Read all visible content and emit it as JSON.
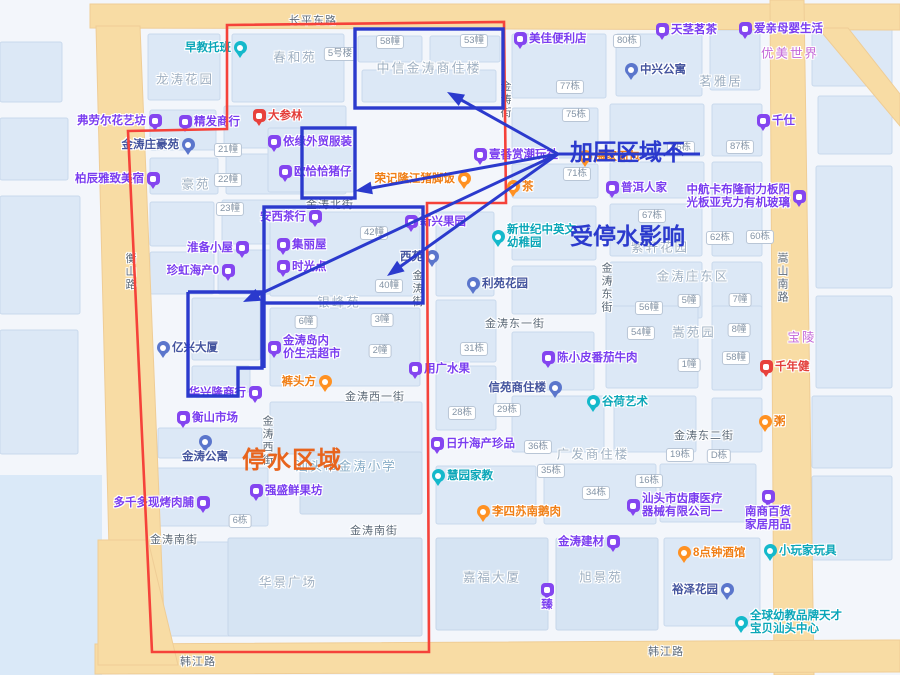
{
  "annotations": {
    "pressure": {
      "line1": "加压区域不",
      "line2": "受停水影响",
      "color": "#2b3acd",
      "x": 570,
      "y": 82
    },
    "outage": {
      "label": "停水区域",
      "color": "#e8641d",
      "x": 242,
      "y": 440
    }
  },
  "roads": {
    "labels": [
      {
        "t": "长平东路",
        "x": 313,
        "y": 20
      },
      {
        "t": "韩江路",
        "x": 198,
        "y": 661
      },
      {
        "t": "韩江路",
        "x": 666,
        "y": 651
      },
      {
        "t": "衡山路",
        "x": 130,
        "y": 272,
        "v": true
      },
      {
        "t": "金涛北街",
        "x": 330,
        "y": 204
      },
      {
        "t": "金涛街",
        "x": 417,
        "y": 289,
        "v": true
      },
      {
        "t": "金涛街",
        "x": 505,
        "y": 100,
        "v": true
      },
      {
        "t": "金涛东街",
        "x": 606,
        "y": 288,
        "v": true
      },
      {
        "t": "嵩山南路",
        "x": 782,
        "y": 278,
        "v": true
      },
      {
        "t": "金涛东一街",
        "x": 515,
        "y": 323
      },
      {
        "t": "金涛西一街",
        "x": 375,
        "y": 396
      },
      {
        "t": "金涛东二街",
        "x": 704,
        "y": 435
      },
      {
        "t": "金涛南街",
        "x": 174,
        "y": 539
      },
      {
        "t": "金涛南街",
        "x": 374,
        "y": 530
      },
      {
        "t": "金涛西街",
        "x": 267,
        "y": 441,
        "v": true
      }
    ]
  },
  "areas": {
    "labels": [
      {
        "t": "龙涛花园",
        "x": 185,
        "y": 78
      },
      {
        "t": "春和苑",
        "x": 295,
        "y": 56
      },
      {
        "t": "中信金涛商住楼",
        "x": 429,
        "y": 67,
        "fs": 13
      },
      {
        "t": "豪苑",
        "x": 196,
        "y": 183
      },
      {
        "t": "茗雅居",
        "x": 721,
        "y": 80
      },
      {
        "t": "优美世界",
        "x": 790,
        "y": 52,
        "c": "#c468d8"
      },
      {
        "t": "紫轩花园",
        "x": 660,
        "y": 246
      },
      {
        "t": "金涛庄东区",
        "x": 693,
        "y": 275
      },
      {
        "t": "嵩苑园",
        "x": 694,
        "y": 331
      },
      {
        "t": "银峰苑",
        "x": 339,
        "y": 301
      },
      {
        "t": "华景广场",
        "x": 288,
        "y": 581
      },
      {
        "t": "嘉福大厦",
        "x": 492,
        "y": 576
      },
      {
        "t": "旭景苑",
        "x": 601,
        "y": 576
      },
      {
        "t": "汕头市金涛小学",
        "x": 346,
        "y": 465,
        "c": "#85abc6"
      },
      {
        "t": "广发商住楼",
        "x": 593,
        "y": 453
      },
      {
        "t": "宝陵",
        "x": 802,
        "y": 336,
        "c": "#c468d8"
      }
    ]
  },
  "buildings": {
    "badges": [
      {
        "t": "21幢",
        "x": 228,
        "y": 150
      },
      {
        "t": "22幢",
        "x": 228,
        "y": 180
      },
      {
        "t": "23幢",
        "x": 230,
        "y": 209
      },
      {
        "t": "5号楼",
        "x": 340,
        "y": 54
      },
      {
        "t": "58幢",
        "x": 390,
        "y": 42
      },
      {
        "t": "53幢",
        "x": 474,
        "y": 41
      },
      {
        "t": "80栋",
        "x": 627,
        "y": 41
      },
      {
        "t": "77栋",
        "x": 570,
        "y": 87
      },
      {
        "t": "75栋",
        "x": 576,
        "y": 115
      },
      {
        "t": "86栋",
        "x": 681,
        "y": 148
      },
      {
        "t": "87栋",
        "x": 740,
        "y": 147
      },
      {
        "t": "71栋",
        "x": 577,
        "y": 174
      },
      {
        "t": "67栋",
        "x": 652,
        "y": 216
      },
      {
        "t": "62栋",
        "x": 720,
        "y": 238
      },
      {
        "t": "60栋",
        "x": 760,
        "y": 237
      },
      {
        "t": "42幢",
        "x": 374,
        "y": 233
      },
      {
        "t": "40幢",
        "x": 389,
        "y": 286
      },
      {
        "t": "6幢",
        "x": 306,
        "y": 322
      },
      {
        "t": "3幢",
        "x": 382,
        "y": 320
      },
      {
        "t": "2幢",
        "x": 380,
        "y": 351
      },
      {
        "t": "31栋",
        "x": 474,
        "y": 349
      },
      {
        "t": "28栋",
        "x": 462,
        "y": 413
      },
      {
        "t": "29栋",
        "x": 507,
        "y": 410
      },
      {
        "t": "36栋",
        "x": 538,
        "y": 447
      },
      {
        "t": "56幢",
        "x": 649,
        "y": 308
      },
      {
        "t": "54幢",
        "x": 641,
        "y": 333
      },
      {
        "t": "5幢",
        "x": 689,
        "y": 301
      },
      {
        "t": "7幢",
        "x": 740,
        "y": 300
      },
      {
        "t": "8幢",
        "x": 739,
        "y": 330
      },
      {
        "t": "58幢",
        "x": 736,
        "y": 358
      },
      {
        "t": "1幢",
        "x": 689,
        "y": 365
      },
      {
        "t": "35栋",
        "x": 551,
        "y": 471
      },
      {
        "t": "34栋",
        "x": 596,
        "y": 493
      },
      {
        "t": "16栋",
        "x": 649,
        "y": 481
      },
      {
        "t": "19栋",
        "x": 680,
        "y": 455
      },
      {
        "t": "D栋",
        "x": 719,
        "y": 456
      },
      {
        "t": "6栋",
        "x": 240,
        "y": 521
      }
    ]
  },
  "pois": {
    "markers": [
      {
        "t": "早教托班",
        "x": 240,
        "y": 48,
        "pin": "teal",
        "side": "left"
      },
      {
        "t": "弗劳尔花艺坊",
        "x": 155,
        "y": 121,
        "pin": "purple",
        "side": "left"
      },
      {
        "t": "精发商行",
        "x": 185,
        "y": 122,
        "pin": "purple",
        "side": "right"
      },
      {
        "t": "大参林",
        "x": 259,
        "y": 116,
        "pin": "red",
        "side": "right"
      },
      {
        "t": "金涛庄豪苑",
        "x": 188,
        "y": 145,
        "pin": "blue",
        "side": "left"
      },
      {
        "t": "柏辰雅致美宿",
        "x": 153,
        "y": 179,
        "pin": "purple",
        "side": "left"
      },
      {
        "t": "依缘外贸服装",
        "x": 274,
        "y": 142,
        "pin": "purple",
        "side": "right"
      },
      {
        "t": "欧恰恰猪仔",
        "x": 285,
        "y": 172,
        "pin": "purple",
        "side": "right"
      },
      {
        "t": "美佳便利店",
        "x": 520,
        "y": 39,
        "pin": "purple",
        "side": "right"
      },
      {
        "t": "天茎茗茶",
        "x": 662,
        "y": 30,
        "pin": "purple",
        "side": "right"
      },
      {
        "t": "爱亲母婴生活",
        "x": 745,
        "y": 29,
        "pin": "purple",
        "side": "right"
      },
      {
        "t": "中兴公寓",
        "x": 631,
        "y": 70,
        "pin": "blue",
        "side": "right"
      },
      {
        "t": "千仕",
        "x": 763,
        "y": 121,
        "pin": "purple",
        "side": "right"
      },
      {
        "t": "梅家面包",
        "x": 585,
        "y": 157,
        "pin": "orange",
        "side": "right"
      },
      {
        "t": "普洱人家",
        "x": 612,
        "y": 188,
        "pin": "purple",
        "side": "right"
      },
      {
        "t": "中航卡布隆耐力板阳\n光板亚克力有机玻璃",
        "x": 799,
        "y": 197,
        "pin": "purple",
        "side": "left"
      },
      {
        "t": "壹番赏潮玩社",
        "x": 480,
        "y": 155,
        "pin": "purple",
        "side": "right"
      },
      {
        "t": "荣记隆江猪脚饭",
        "x": 464,
        "y": 179,
        "pin": "orange",
        "side": "left"
      },
      {
        "t": "茶",
        "x": 513,
        "y": 187,
        "pin": "orange",
        "side": "right"
      },
      {
        "t": "安西茶行",
        "x": 315,
        "y": 217,
        "pin": "purple",
        "side": "left"
      },
      {
        "t": "新兴果园",
        "x": 411,
        "y": 222,
        "pin": "purple",
        "side": "right"
      },
      {
        "t": "集丽屋",
        "x": 283,
        "y": 245,
        "pin": "purple",
        "side": "right"
      },
      {
        "t": "时光点",
        "x": 283,
        "y": 267,
        "pin": "purple",
        "side": "right"
      },
      {
        "t": "西苑",
        "x": 432,
        "y": 257,
        "pin": "blue",
        "side": "left"
      },
      {
        "t": "新世纪中英文\n幼稚园",
        "x": 498,
        "y": 237,
        "pin": "teal",
        "side": "right"
      },
      {
        "t": "利苑花园",
        "x": 473,
        "y": 284,
        "pin": "blue",
        "side": "right"
      },
      {
        "t": "珍虹海产0",
        "x": 228,
        "y": 271,
        "pin": "purple",
        "side": "left"
      },
      {
        "t": "淮备小屋",
        "x": 242,
        "y": 248,
        "pin": "purple",
        "side": "left"
      },
      {
        "t": "亿兴大厦",
        "x": 163,
        "y": 348,
        "pin": "blue",
        "side": "right"
      },
      {
        "t": "金涛岛内\n价生活超市",
        "x": 274,
        "y": 348,
        "pin": "purple",
        "side": "right"
      },
      {
        "t": "华兴隆商行",
        "x": 255,
        "y": 393,
        "pin": "purple",
        "side": "left"
      },
      {
        "t": "衡山市场",
        "x": 183,
        "y": 418,
        "pin": "purple",
        "side": "right"
      },
      {
        "t": "金涛公寓",
        "x": 205,
        "y": 442,
        "pin": "blue",
        "side": "below"
      },
      {
        "t": "裤头方",
        "x": 325,
        "y": 382,
        "pin": "orange",
        "side": "left"
      },
      {
        "t": "用广水果",
        "x": 415,
        "y": 369,
        "pin": "purple",
        "side": "right"
      },
      {
        "t": "陈小皮番茄牛肉",
        "x": 548,
        "y": 358,
        "pin": "purple",
        "side": "right"
      },
      {
        "t": "信苑商住楼",
        "x": 555,
        "y": 388,
        "pin": "blue",
        "side": "left"
      },
      {
        "t": "日升海产珍品",
        "x": 437,
        "y": 444,
        "pin": "purple",
        "side": "right"
      },
      {
        "t": "谷荷艺术",
        "x": 593,
        "y": 402,
        "pin": "teal",
        "side": "right"
      },
      {
        "t": "千年健",
        "x": 766,
        "y": 367,
        "pin": "red",
        "side": "right"
      },
      {
        "t": "粥",
        "x": 765,
        "y": 422,
        "pin": "orange",
        "side": "right"
      },
      {
        "t": "强盛鲜果坊",
        "x": 256,
        "y": 491,
        "pin": "purple",
        "side": "right"
      },
      {
        "t": "多千多现烤肉脯",
        "x": 203,
        "y": 503,
        "pin": "purple",
        "side": "left"
      },
      {
        "t": "慧园家教",
        "x": 438,
        "y": 476,
        "pin": "teal",
        "side": "right"
      },
      {
        "t": "李四苏南鹅肉",
        "x": 483,
        "y": 512,
        "pin": "orange",
        "side": "right"
      },
      {
        "t": "汕头市齿康医疗\n器械有限公司一",
        "x": 633,
        "y": 506,
        "pin": "purple",
        "side": "right"
      },
      {
        "t": "金涛建材",
        "x": 613,
        "y": 542,
        "pin": "purple",
        "side": "left"
      },
      {
        "t": "臻",
        "x": 547,
        "y": 590,
        "pin": "purple",
        "side": "below"
      },
      {
        "t": "8点钟酒馆",
        "x": 684,
        "y": 553,
        "pin": "orange",
        "side": "right"
      },
      {
        "t": "小玩家玩具",
        "x": 770,
        "y": 551,
        "pin": "teal",
        "side": "right"
      },
      {
        "t": "南商百货\n家居用品",
        "x": 768,
        "y": 497,
        "pin": "purple",
        "side": "below"
      },
      {
        "t": "裕泽花园",
        "x": 727,
        "y": 590,
        "pin": "blue",
        "side": "left"
      },
      {
        "t": "全球幼教品牌天才\n宝贝汕头中心",
        "x": 741,
        "y": 623,
        "pin": "teal",
        "side": "right"
      }
    ]
  },
  "overlay": {
    "blue": "#2b3acd",
    "red": "#f5423a",
    "red_polygon": [
      [
        227,
        25
      ],
      [
        504,
        22
      ],
      [
        506,
        203
      ],
      [
        427,
        203
      ],
      [
        429,
        652
      ],
      [
        152,
        652
      ],
      [
        128,
        131
      ],
      [
        227,
        129
      ]
    ],
    "blue_rects": [
      [
        355,
        29,
        148,
        79
      ],
      [
        302,
        128,
        53,
        70
      ],
      [
        264,
        207,
        159,
        96
      ]
    ],
    "blue_polylines": [
      [
        [
          264,
          303
        ],
        [
          264,
          368
        ]
      ],
      [
        [
          188,
          292
        ],
        [
          262,
          292
        ],
        [
          262,
          368
        ],
        [
          238,
          368
        ],
        [
          238,
          396
        ],
        [
          188,
          396
        ],
        [
          188,
          292
        ]
      ]
    ],
    "leader": [
      [
        558,
        154
      ],
      [
        700,
        154
      ]
    ],
    "arrows": [
      [
        [
          558,
          154
        ],
        [
          447,
          92
        ]
      ],
      [
        [
          558,
          154
        ],
        [
          355,
          191
        ]
      ],
      [
        [
          558,
          154
        ],
        [
          387,
          276
        ]
      ],
      [
        [
          558,
          154
        ],
        [
          243,
          302
        ]
      ]
    ]
  }
}
